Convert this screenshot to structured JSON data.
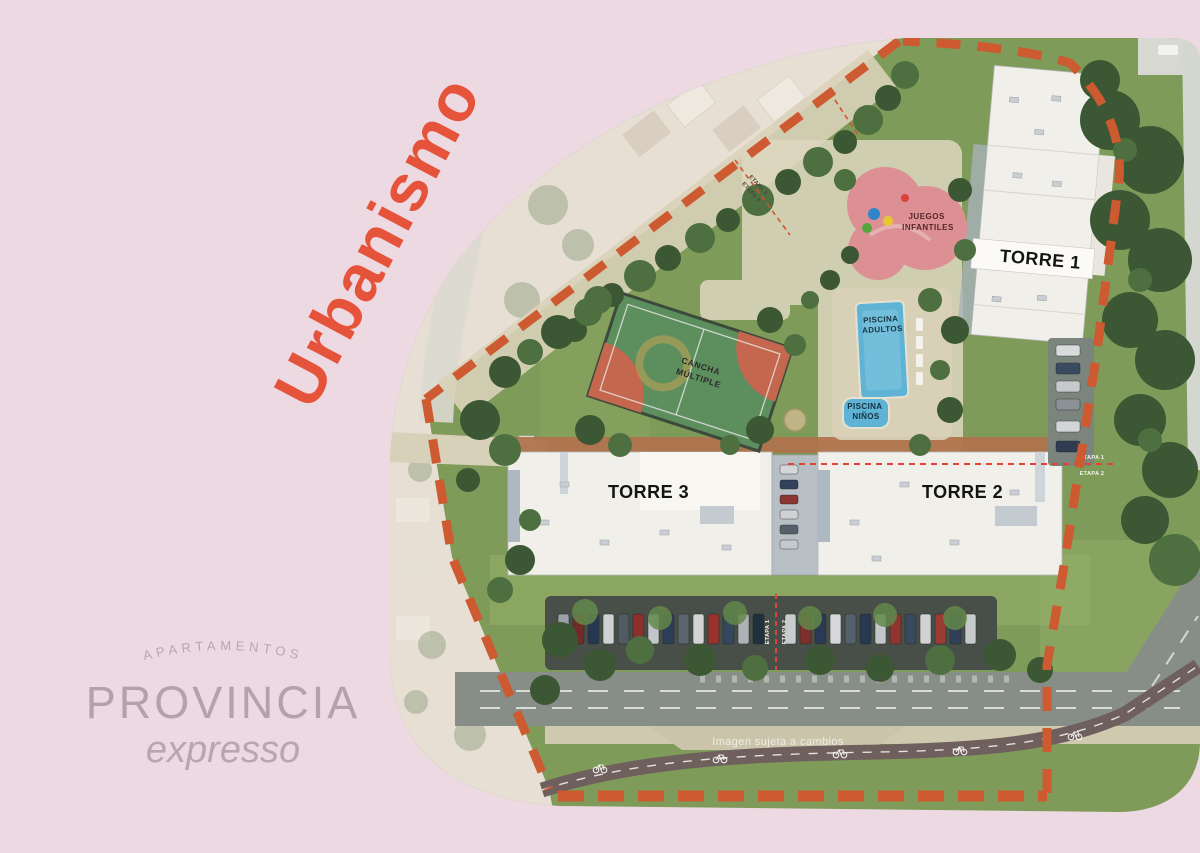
{
  "title": {
    "text": "Urbanismo"
  },
  "logo": {
    "tagline": "APARTAMENTOS",
    "name": "PROVINCIA",
    "script": "expresso"
  },
  "plan": {
    "tower1": "TORRE 1",
    "tower2": "TORRE 2",
    "tower3": "TORRE 3",
    "cancha_line1": "CANCHA",
    "cancha_line2": "MÚLTIPLE",
    "piscina_adultos_line1": "PISCINA",
    "piscina_adultos_line2": "ADULTOS",
    "piscina_ninos_line1": "PISCINA",
    "piscina_ninos_line2": "NIÑOS",
    "juegos_line1": "JUEGOS",
    "juegos_line2": "INFANTILES",
    "disclaimer": "Imagen sujeta a cambios",
    "etapa_top_a": "ETAPA 2",
    "etapa_top_b": "ETAPA 3",
    "etapa_right_a": "ETAPA 1",
    "etapa_right_b": "ETAPA 2",
    "etapa_parking_a": "ETAPA 1",
    "etapa_parking_b": "ETAPA 2"
  },
  "colors": {
    "background": "#edd9e2",
    "accent_title": "#e5533a",
    "boundary_dash": "#cd5a30",
    "stage_line": "#e04432",
    "logo": "#b7a6b1",
    "pool": "#5fb3d4",
    "court": "#5d8e5e",
    "playground": "#dd9093"
  }
}
